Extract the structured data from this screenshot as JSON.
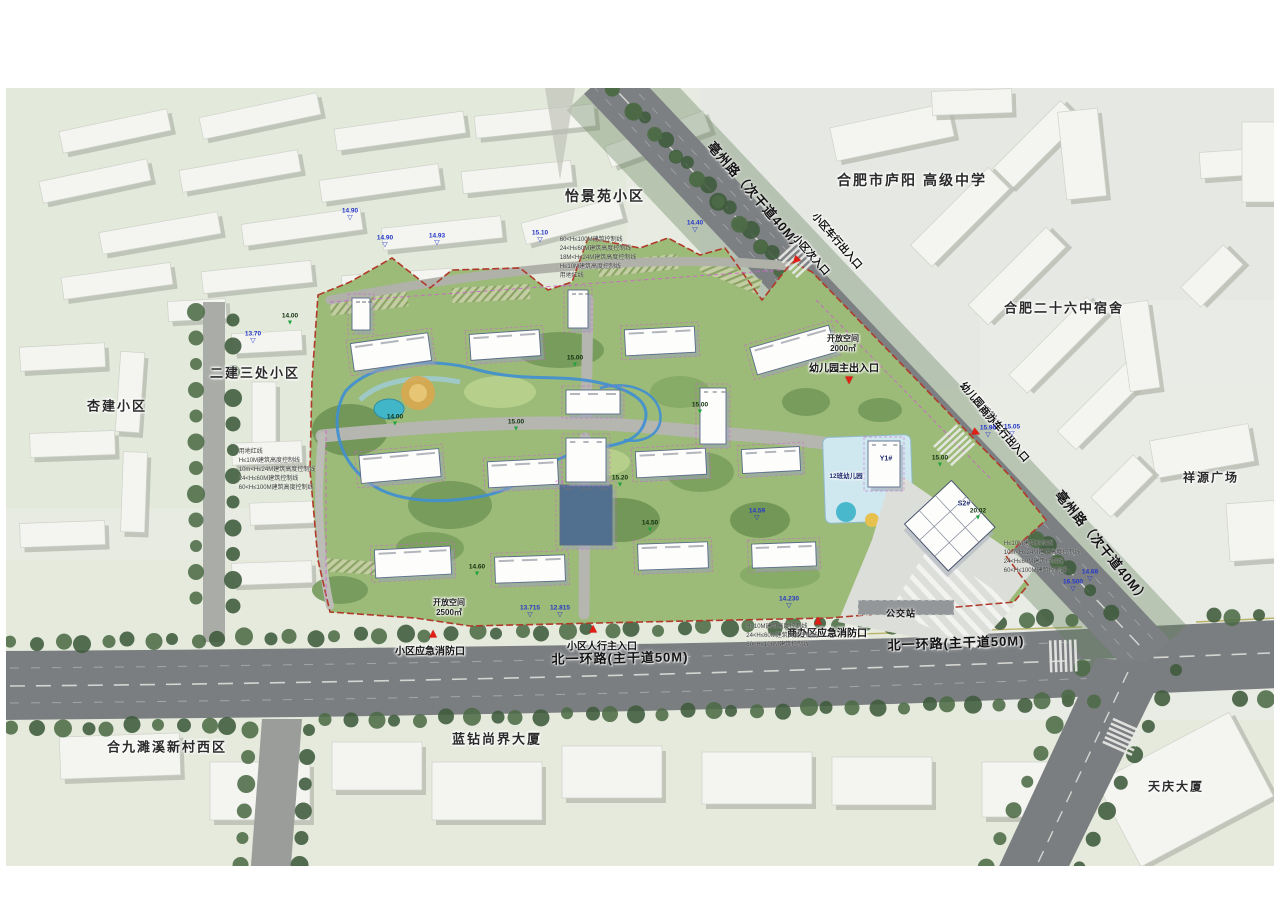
{
  "map": {
    "area_labels": [
      {
        "id": "yijingyuan",
        "text": "怡景苑小区",
        "x": 605,
        "y": 196,
        "size": 14
      },
      {
        "id": "luyang-school",
        "text": "合肥市庐阳 高级中学",
        "x": 912,
        "y": 180,
        "size": 14
      },
      {
        "id": "no26-dorm",
        "text": "合肥二十六中宿舍",
        "x": 1064,
        "y": 307,
        "size": 13
      },
      {
        "id": "xiangyuan",
        "text": "祥源广场",
        "x": 1211,
        "y": 477,
        "size": 12
      },
      {
        "id": "erjiansanchu",
        "text": "二建三处小区",
        "x": 255,
        "y": 372,
        "size": 13
      },
      {
        "id": "xingjian",
        "text": "杏建小区",
        "x": 117,
        "y": 405,
        "size": 13
      },
      {
        "id": "suixi-west",
        "text": "合九濉溪新村西区",
        "x": 167,
        "y": 746,
        "size": 13
      },
      {
        "id": "lanzuan",
        "text": "蓝钻尚界大厦",
        "x": 497,
        "y": 738,
        "size": 13
      },
      {
        "id": "tianqing",
        "text": "天庆大厦",
        "x": 1176,
        "y": 786,
        "size": 12
      }
    ],
    "road_labels": [
      {
        "id": "bozhou-north",
        "text": "亳州路（次干道40M）",
        "x": 757,
        "y": 196,
        "rot": 49
      },
      {
        "id": "bozhou-south",
        "text": "亳州路（次干道40M）",
        "x": 1103,
        "y": 546,
        "rot": 51
      },
      {
        "id": "beiyihuan-west",
        "text": "北一环路(主干道50M)",
        "x": 620,
        "y": 657,
        "rot": -1
      },
      {
        "id": "beiyihuan-east",
        "text": "北一环路(主干道50M)",
        "x": 956,
        "y": 642,
        "rot": -2
      },
      {
        "id": "bus-stop",
        "text": "公交站",
        "x": 901,
        "y": 613,
        "rot": 0,
        "size": 9
      }
    ],
    "entrances": [
      {
        "id": "vehicle-gate",
        "text": "小区车行出入口",
        "tx": 838,
        "ty": 240,
        "rot": 49,
        "mx": 795,
        "my": 261,
        "mrot": -135
      },
      {
        "id": "secondary-gate",
        "text": "小区次入口",
        "tx": 812,
        "ty": 254,
        "rot": 49
      },
      {
        "id": "kindergarten-main",
        "text": "幼儿园主出入口",
        "tx": 844,
        "ty": 367,
        "mx": 849,
        "my": 381,
        "mrot": 180
      },
      {
        "id": "kindergarten-service",
        "text": "幼儿园后勤出入口/",
        "tx": 990,
        "ty": 414,
        "rot": 49,
        "mx": 977,
        "my": 433,
        "mrot": 115
      },
      {
        "id": "office-vehicle-gate",
        "text": "商办车行出入口",
        "tx": 1005,
        "ty": 433,
        "rot": 49
      },
      {
        "id": "pedestrian-main",
        "text": "小区人行主入口",
        "tx": 602,
        "ty": 645,
        "mx": 593,
        "my": 628,
        "mrot": 0
      },
      {
        "id": "fire-exit-residence",
        "text": "小区应急消防口",
        "tx": 430,
        "ty": 650,
        "mx": 433,
        "my": 633,
        "mrot": 0
      },
      {
        "id": "fire-exit-office",
        "text": "商办区应急消防口",
        "tx": 827,
        "ty": 632,
        "mx": 818,
        "my": 620,
        "mrot": 0
      }
    ],
    "site_annotations": [
      {
        "id": "open-space-2000",
        "text": "开放空间\n2000㎡",
        "x": 843,
        "y": 344
      },
      {
        "id": "open-space-2500",
        "text": "开放空间\n2500㎡",
        "x": 449,
        "y": 608
      },
      {
        "id": "kindergarten",
        "text": "12班幼儿园",
        "x": 846,
        "y": 477,
        "size": 6.5
      },
      {
        "id": "building-y1",
        "text": "Y1#",
        "x": 886,
        "y": 460,
        "size": 7
      },
      {
        "id": "building-s2",
        "text": "S2#",
        "x": 964,
        "y": 505,
        "size": 7
      }
    ],
    "control_line_stacks": [
      {
        "id": "north",
        "x": 598,
        "y": 236,
        "lines": [
          "60<H≤100M建筑控制线",
          "24<H≤60M建筑高度控制线",
          "18M<H≤24M建筑高度控制线",
          "H≤10M建筑高度控制线",
          "用地红线"
        ]
      },
      {
        "id": "west",
        "x": 277,
        "y": 448,
        "lines": [
          "用地红线",
          "H≤10M建筑高度控制线",
          "10m<H≤24M建筑高度控制线",
          "24<H≤60M建筑控制线",
          "60<H≤100M建筑高度控制线"
        ]
      },
      {
        "id": "east",
        "x": 1042,
        "y": 540,
        "lines": [
          "H≤10M建筑控制线",
          "10m<H≤24M建筑高度控制线",
          "24<H≤60M建筑控制线",
          "60<H≤100M建筑控制线"
        ]
      },
      {
        "id": "south",
        "x": 782,
        "y": 623,
        "lines": [
          "H≤10M建筑高度控制线",
          "24<H≤60M建筑高度控制线",
          "60<H≤100M建筑控制线"
        ]
      }
    ],
    "spot_elevations": [
      {
        "v": "14.90",
        "x": 350,
        "y": 221,
        "t": "blue"
      },
      {
        "v": "14.90",
        "x": 385,
        "y": 248,
        "t": "blue"
      },
      {
        "v": "14.93",
        "x": 437,
        "y": 246,
        "t": "blue"
      },
      {
        "v": "15.10",
        "x": 540,
        "y": 243,
        "t": "blue"
      },
      {
        "v": "14.40",
        "x": 695,
        "y": 233,
        "t": "blue"
      },
      {
        "v": "13.70",
        "x": 253,
        "y": 344,
        "t": "blue"
      },
      {
        "v": "15.96",
        "x": 988,
        "y": 438,
        "t": "blue"
      },
      {
        "v": "15.05",
        "x": 1012,
        "y": 437,
        "t": "blue"
      },
      {
        "v": "16.500",
        "x": 1073,
        "y": 592,
        "t": "blue"
      },
      {
        "v": "14.68",
        "x": 1090,
        "y": 582,
        "t": "blue"
      },
      {
        "v": "14.230",
        "x": 789,
        "y": 609,
        "t": "blue"
      },
      {
        "v": "13.715",
        "x": 530,
        "y": 618,
        "t": "blue"
      },
      {
        "v": "12.815",
        "x": 560,
        "y": 618,
        "t": "blue"
      },
      {
        "v": "14.59",
        "x": 757,
        "y": 521,
        "t": "blue"
      },
      {
        "v": "15.00",
        "x": 575,
        "y": 368,
        "t": "green"
      },
      {
        "v": "14.00",
        "x": 395,
        "y": 427,
        "t": "green"
      },
      {
        "v": "15.00",
        "x": 516,
        "y": 432,
        "t": "green"
      },
      {
        "v": "14.50",
        "x": 650,
        "y": 533,
        "t": "green"
      },
      {
        "v": "14.60",
        "x": 477,
        "y": 577,
        "t": "green"
      },
      {
        "v": "15.20",
        "x": 620,
        "y": 488,
        "t": "green"
      },
      {
        "v": "15.00",
        "x": 940,
        "y": 468,
        "t": "green"
      },
      {
        "v": "20.02",
        "x": 978,
        "y": 521,
        "t": "green"
      },
      {
        "v": "15.00",
        "x": 700,
        "y": 415,
        "t": "green"
      },
      {
        "v": "14.00",
        "x": 290,
        "y": 326,
        "t": "green"
      }
    ],
    "colors": {
      "site_boundary": "#b03a2a",
      "entrance_marker": "#e11d14",
      "elevation_blue": "#2437c8",
      "elevation_green": "#1fa43d",
      "water": "#3f8fd2",
      "road": "#7b7e81",
      "lawn": "#9cba78"
    }
  }
}
